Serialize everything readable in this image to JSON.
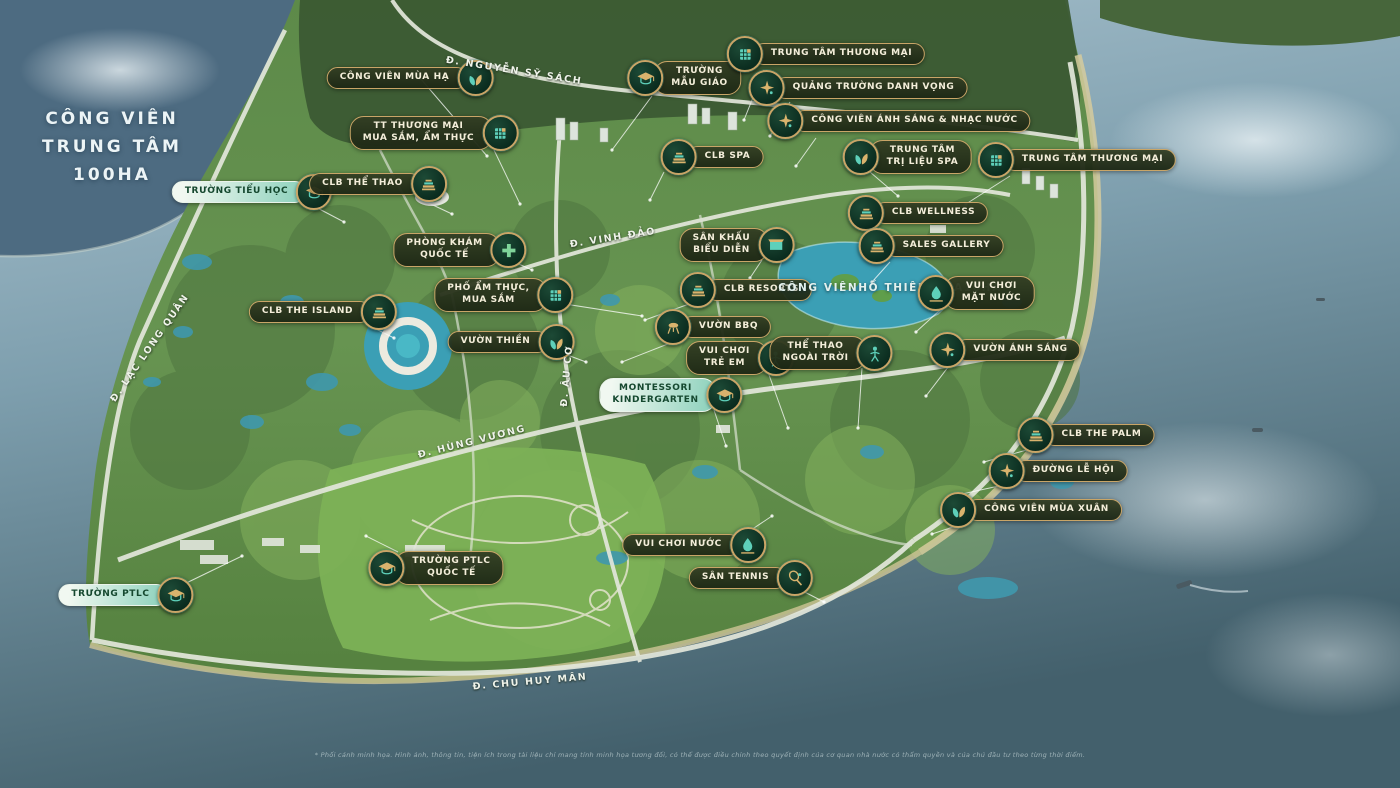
{
  "title": {
    "lines": [
      "CÔNG VIÊN",
      "TRUNG TÂM",
      "100HA"
    ],
    "x": 112,
    "y": 147
  },
  "colors": {
    "pill_bg": "#28351d",
    "pill_border": "#c9a567",
    "pill_text": "#f4eeda",
    "pill_light_bg": "#8fd2bd",
    "pill_light_text": "#15482f",
    "icon_bg": "#0a2b1e",
    "icon_gold": "#d9b36d",
    "icon_teal": "#5ed0ba",
    "water": "#7e9fae",
    "lake": "#4d6b81",
    "land": "#679451",
    "pond": "#3f98ad"
  },
  "labels": [
    {
      "id": "summer-park",
      "lines": [
        "CÔNG VIÊN MÙA HẠ"
      ],
      "icon": "leaf",
      "side": "right",
      "variant": "dark",
      "x": 410,
      "y": 78
    },
    {
      "id": "kindergarten",
      "lines": [
        "TRƯỜNG",
        "MẪU GIÁO"
      ],
      "icon": "cap",
      "side": "left",
      "variant": "dark",
      "x": 684,
      "y": 78
    },
    {
      "id": "mall-north",
      "lines": [
        "TRUNG TÂM THƯƠNG MẠI"
      ],
      "icon": "grid",
      "side": "left",
      "variant": "dark",
      "x": 826,
      "y": 54
    },
    {
      "id": "fame-square",
      "lines": [
        "QUẢNG TRƯỜNG DANH VỌNG"
      ],
      "icon": "spark",
      "side": "left",
      "variant": "dark",
      "x": 858,
      "y": 88
    },
    {
      "id": "light-music-park",
      "lines": [
        "CÔNG VIÊN ÁNH SÁNG & NHẠC NƯỚC"
      ],
      "icon": "spark",
      "side": "left",
      "variant": "dark",
      "x": 899,
      "y": 121
    },
    {
      "id": "shopping-food-center",
      "lines": [
        "TT THƯƠNG MẠI",
        "MUA SẮM, ẨM THỰC"
      ],
      "icon": "grid",
      "side": "right",
      "variant": "dark",
      "x": 434,
      "y": 133
    },
    {
      "id": "clb-spa",
      "lines": [
        "CLB SPA"
      ],
      "icon": "building",
      "side": "left",
      "variant": "dark",
      "x": 712,
      "y": 157
    },
    {
      "id": "spa-therapy-center",
      "lines": [
        "TRUNG TÂM",
        "TRỊ LIỆU SPA"
      ],
      "icon": "leaf",
      "side": "left",
      "variant": "dark",
      "x": 907,
      "y": 157
    },
    {
      "id": "mall-east",
      "lines": [
        "TRUNG TÂM THƯƠNG MẠI"
      ],
      "icon": "grid",
      "side": "left",
      "variant": "dark",
      "x": 1077,
      "y": 160
    },
    {
      "id": "primary-school",
      "lines": [
        "TRƯỜNG TIỂU HỌC"
      ],
      "icon": "cap",
      "side": "right",
      "variant": "light",
      "x": 252,
      "y": 192
    },
    {
      "id": "clb-the-thao",
      "lines": [
        "CLB THỂ THAO"
      ],
      "icon": "building",
      "side": "right",
      "variant": "dark",
      "x": 378,
      "y": 184
    },
    {
      "id": "clb-wellness",
      "lines": [
        "CLB WELLNESS"
      ],
      "icon": "building",
      "side": "left",
      "variant": "dark",
      "x": 918,
      "y": 213
    },
    {
      "id": "intl-clinic",
      "lines": [
        "PHÒNG KHÁM",
        "QUỐC TẾ"
      ],
      "icon": "cross",
      "side": "right",
      "variant": "dark",
      "x": 460,
      "y": 250
    },
    {
      "id": "sales-gallery",
      "lines": [
        "SALES GALLERY"
      ],
      "icon": "building",
      "side": "left",
      "variant": "dark",
      "x": 931,
      "y": 246
    },
    {
      "id": "performance-stage",
      "lines": [
        "SÂN KHẤU",
        "BIỂU DIỄN"
      ],
      "icon": "stage",
      "side": "right",
      "variant": "dark",
      "x": 737,
      "y": 245
    },
    {
      "id": "clb-resorts",
      "lines": [
        "CLB RESORTS"
      ],
      "icon": "building",
      "side": "left",
      "variant": "dark",
      "x": 746,
      "y": 290
    },
    {
      "id": "swan-lake-park",
      "lines": [
        "CÔNG VIÊN",
        "HỒ THIÊN NGA",
        "10HA"
      ],
      "icon": "",
      "side": "",
      "variant": "plain",
      "x": 890,
      "y": 288
    },
    {
      "id": "water-play",
      "lines": [
        "VUI CHƠI",
        "MẶT NƯỚC"
      ],
      "icon": "droplet",
      "side": "left",
      "variant": "dark",
      "x": 976,
      "y": 293
    },
    {
      "id": "food-street",
      "lines": [
        "PHỐ ẨM THỰC,",
        "MUA SẮM"
      ],
      "icon": "grid",
      "side": "right",
      "variant": "dark",
      "x": 504,
      "y": 295
    },
    {
      "id": "bbq-garden",
      "lines": [
        "VƯỜN BBQ"
      ],
      "icon": "grill",
      "side": "left",
      "variant": "dark",
      "x": 713,
      "y": 327
    },
    {
      "id": "clb-the-island",
      "lines": [
        "CLB THE ISLAND"
      ],
      "icon": "building",
      "side": "right",
      "variant": "dark",
      "x": 323,
      "y": 312
    },
    {
      "id": "zen-garden",
      "lines": [
        "VƯỜN THIỀN"
      ],
      "icon": "leaf",
      "side": "right",
      "variant": "dark",
      "x": 511,
      "y": 342
    },
    {
      "id": "kids-playground",
      "lines": [
        "VUI CHƠI",
        "TRẺ EM"
      ],
      "icon": "person",
      "side": "right",
      "variant": "dark",
      "x": 740,
      "y": 358
    },
    {
      "id": "outdoor-sports",
      "lines": [
        "THỂ THAO",
        "NGOÀI TRỜI"
      ],
      "icon": "person",
      "side": "right",
      "variant": "dark",
      "x": 831,
      "y": 353
    },
    {
      "id": "light-garden",
      "lines": [
        "VƯỜN ÁNH SÁNG"
      ],
      "icon": "spark",
      "side": "left",
      "variant": "dark",
      "x": 1005,
      "y": 350
    },
    {
      "id": "montessori-kindergarten",
      "lines": [
        "MONTESSORI",
        "KINDERGARTEN"
      ],
      "icon": "cap",
      "side": "right",
      "variant": "light",
      "x": 671,
      "y": 395
    },
    {
      "id": "clb-the-palm",
      "lines": [
        "CLB THE PALM"
      ],
      "icon": "building",
      "side": "left",
      "variant": "dark",
      "x": 1086,
      "y": 435
    },
    {
      "id": "festival-street",
      "lines": [
        "ĐƯỜNG LỄ HỘI"
      ],
      "icon": "spark",
      "side": "left",
      "variant": "dark",
      "x": 1058,
      "y": 471
    },
    {
      "id": "spring-park",
      "lines": [
        "CÔNG VIÊN MÙA XUÂN"
      ],
      "icon": "leaf",
      "side": "left",
      "variant": "dark",
      "x": 1031,
      "y": 510
    },
    {
      "id": "water-fun-park",
      "lines": [
        "VUI CHƠI NƯỚC"
      ],
      "icon": "droplet",
      "side": "right",
      "variant": "dark",
      "x": 694,
      "y": 545
    },
    {
      "id": "tennis-court",
      "lines": [
        "SÂN TENNIS"
      ],
      "icon": "tennis",
      "side": "right",
      "variant": "dark",
      "x": 751,
      "y": 578
    },
    {
      "id": "ptlc-intl-school",
      "lines": [
        "TRƯỜNG PTLC",
        "QUỐC TẾ"
      ],
      "icon": "cap",
      "side": "left",
      "variant": "dark",
      "x": 436,
      "y": 568
    },
    {
      "id": "ptlc-school",
      "lines": [
        "TRƯỜNG PTLC"
      ],
      "icon": "cap",
      "side": "right",
      "variant": "light",
      "x": 126,
      "y": 595
    }
  ],
  "roads": [
    {
      "id": "nguyen-sy-sach",
      "text": "Đ. NGUYỄN SỸ SÁCH",
      "x": 514,
      "y": 71,
      "rot": 9
    },
    {
      "id": "vinh-dao",
      "text": "Đ. VINH ĐẢO",
      "x": 613,
      "y": 238,
      "rot": -9
    },
    {
      "id": "lac-long-quan",
      "text": "Đ. LẠC LONG QUÂN",
      "x": 150,
      "y": 348,
      "rot": -55
    },
    {
      "id": "au-co",
      "text": "Đ. ÂU CƠ",
      "x": 567,
      "y": 376,
      "rot": -85
    },
    {
      "id": "hung-vuong",
      "text": "Đ. HÙNG VƯƠNG",
      "x": 472,
      "y": 442,
      "rot": -14
    },
    {
      "id": "chu-huy-man",
      "text": "Đ. CHU HUY MÂN",
      "x": 530,
      "y": 682,
      "rot": -5
    }
  ],
  "disclaimer": "* Phối cảnh minh họa. Hình ảnh, thông tin, tiện ích trong tài liệu chỉ mang tính minh họa tương đối, có thể được điều chỉnh theo quyết định của cơ quan nhà nước có thẩm quyền và của chủ đầu tư theo từng thời điểm."
}
